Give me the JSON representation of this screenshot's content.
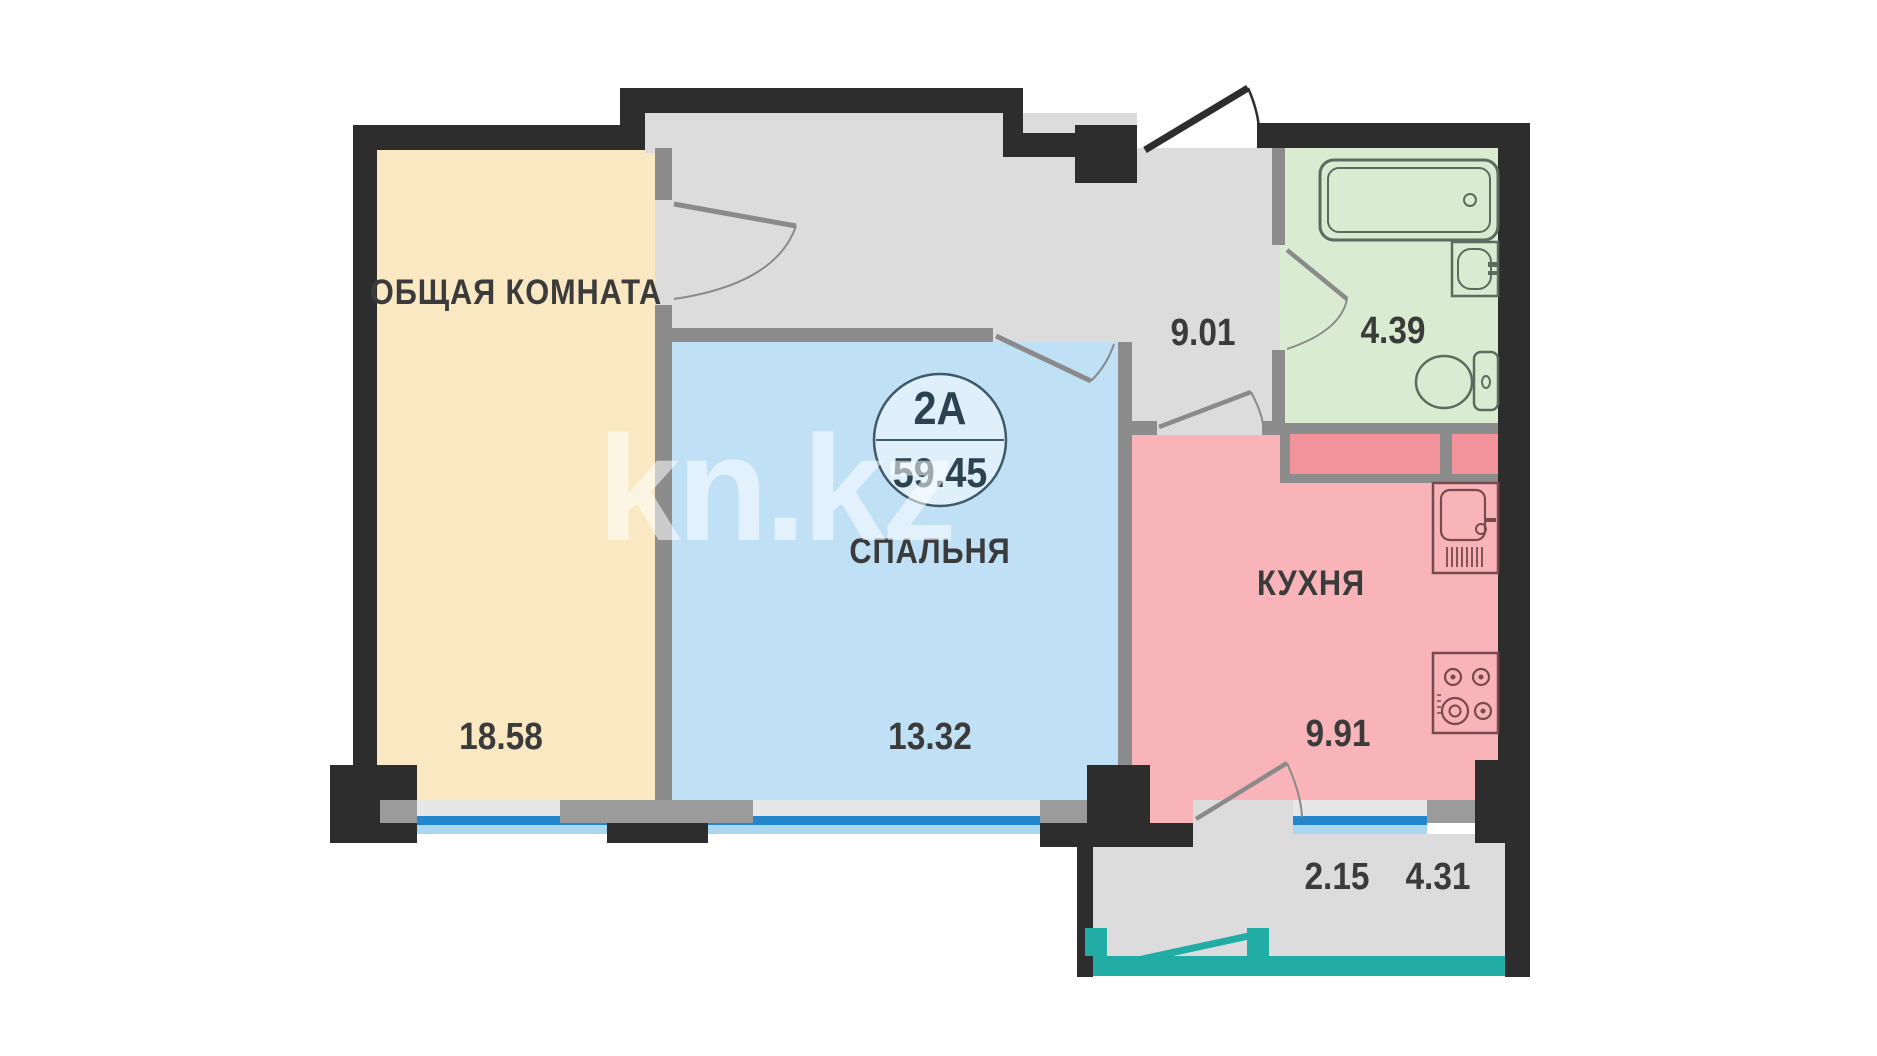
{
  "plan": {
    "unit": {
      "label": "2А",
      "area": "59.45"
    },
    "rooms": {
      "living": {
        "name": "ОБЩАЯ КОМНАТА",
        "area": "18.58"
      },
      "bedroom": {
        "name": "СПАЛЬНЯ",
        "area": "13.32"
      },
      "kitchen": {
        "name": "КУХНЯ",
        "area": "9.91"
      },
      "hallway": {
        "area": "9.01"
      },
      "bathroom": {
        "area": "4.39"
      },
      "balcony": {
        "area_coef": "2.15",
        "area_full": "4.31"
      }
    },
    "watermark": {
      "text": "kn.kz"
    },
    "colors": {
      "living": "#F9E8C2",
      "bedroom": "#BFE0F5",
      "kitchen": "#F8B4B8",
      "bathroom": "#D9ECD2",
      "hallway": "#DCDCDC",
      "balcony_glazing": "#22ACA6",
      "window_glass": "#2386CB",
      "outer_wall": "#2D2D2D",
      "partition": "#8C8C8C",
      "vent_shaft": "#F2939B"
    }
  }
}
